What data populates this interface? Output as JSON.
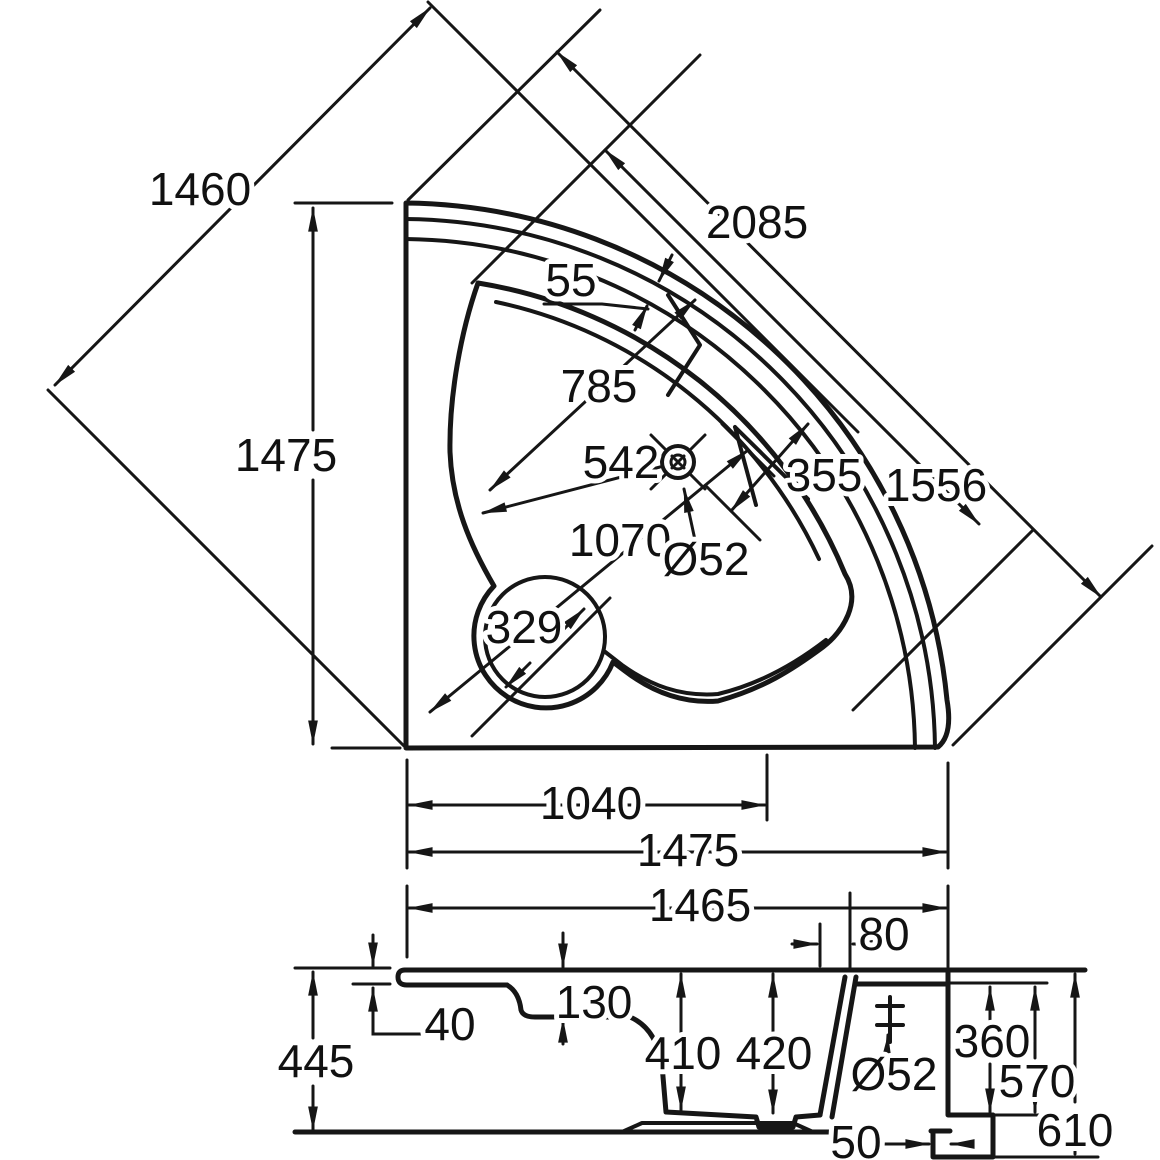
{
  "drawing": {
    "type": "corner-bathtub-dimension-drawing",
    "units": "mm",
    "plan_view": {
      "diagonal_width": "1460",
      "left_side": "1475",
      "overall_diagonal": "2085",
      "rim_edge_width": "55",
      "well_width": "785",
      "drain_distance": "542",
      "inner_diagonal": "1556",
      "rim_inset": "355",
      "well_length": "1070",
      "seat_diameter": "329",
      "drain_diameter": "Ø52",
      "drain_offset": "1040",
      "bottom_side": "1475"
    },
    "section_view": {
      "overall_width": "1465",
      "rim_thickness": "40",
      "overall_height": "445",
      "rim_step": "130",
      "depth_front": "410",
      "depth_rear": "420",
      "rear_deck": "80",
      "drain_diameter": "Ø52",
      "drain_height": "360",
      "step_height": "570",
      "skirt_height": "610",
      "foot_inset": "50"
    }
  }
}
